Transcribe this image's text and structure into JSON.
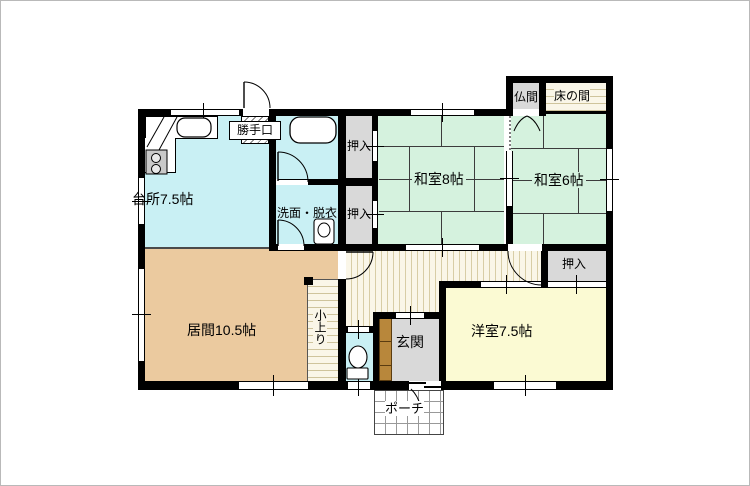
{
  "title": "間取り図",
  "colors": {
    "wall": "#000000",
    "water_room": "#c9f0f4",
    "tatami": "#d5f2de",
    "living": "#ebca9f",
    "western": "#fbfad3",
    "hall": "#faf6e8",
    "hall_stripe": "#d8cda6",
    "closet_gray": "#d9d9d9",
    "cabinet_brown": "#b8873b",
    "porch": "#ffffff"
  },
  "rooms": {
    "kitchen": {
      "label": "台所7.5帖"
    },
    "living": {
      "label": "居間10.5帖"
    },
    "washroom": {
      "label": "洗面・脱衣"
    },
    "washitsu8": {
      "label": "和室8帖"
    },
    "washitsu6": {
      "label": "和室6帖"
    },
    "western": {
      "label": "洋室7.5帖"
    },
    "entrance": {
      "label": "玄関"
    },
    "porch": {
      "label": "ポーチ"
    },
    "butsuma": {
      "label": "仏間"
    },
    "tokonoma": {
      "label": "床の間"
    },
    "koagari": {
      "label": "小上り"
    },
    "backdoor": {
      "label": "勝手口"
    },
    "closet_left_top": {
      "label": "押入"
    },
    "closet_left_bottom": {
      "label": "押入"
    },
    "closet_right": {
      "label": "押入"
    }
  }
}
